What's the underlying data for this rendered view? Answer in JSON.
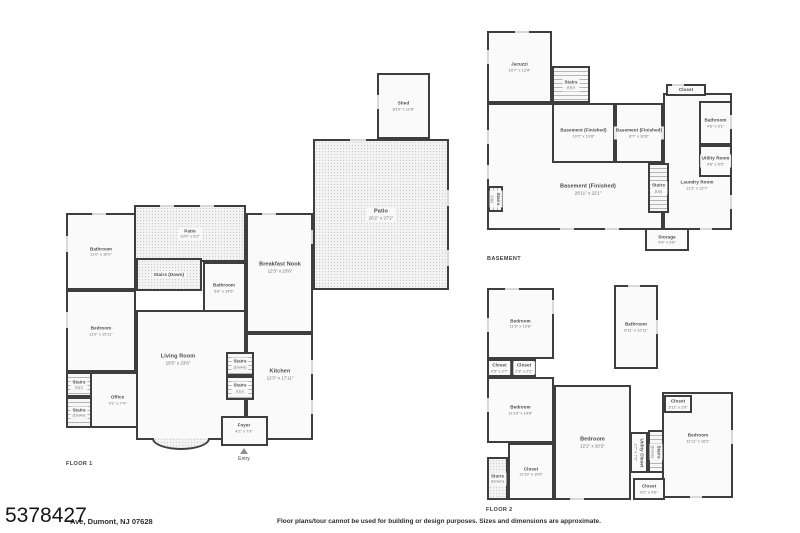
{
  "meta": {
    "mls_number": "5378427",
    "address": "Ave, Dumont, NJ 07628",
    "disclaimer": "Floor plans/tour cannot be used for building or design purposes. Sizes and dimensions are approximate."
  },
  "colors": {
    "wall": "#3e3e3e",
    "floor_fill": "#fafafa",
    "patio_fill": "#f3f3f3",
    "label_text": "#4a4a4a"
  },
  "plans": [
    {
      "id": "floor-1",
      "label": "FLOOR 1",
      "label_x": 66,
      "label_y": 461,
      "entry": {
        "label": "Entry",
        "x": 244,
        "y": 448
      },
      "bay": {
        "x": 152,
        "y": 438,
        "w": 58,
        "h": 12
      },
      "rooms": [
        {
          "name": "Patio",
          "dims": "26'2\" x 27'2\"",
          "x": 313,
          "y": 139,
          "w": 136,
          "h": 151,
          "type": "patio"
        },
        {
          "name": "Shed",
          "dims": "8'10\" x 11'8\"",
          "x": 377,
          "y": 73,
          "w": 53,
          "h": 66,
          "small": true
        },
        {
          "name": "Patio",
          "dims": "19'0\" x 6'2\"",
          "x": 134,
          "y": 205,
          "w": 112,
          "h": 57,
          "type": "patio",
          "small": true
        },
        {
          "name": "Bathroom",
          "dims": "11'0\" x 10'0\"",
          "x": 66,
          "y": 213,
          "w": 70,
          "h": 77,
          "small": true
        },
        {
          "name": "Bedroom",
          "dims": "11'9\" x 15'11\"",
          "x": 66,
          "y": 290,
          "w": 70,
          "h": 82,
          "small": true
        },
        {
          "name": "Office",
          "dims": "9'1\" x 7'4\"",
          "x": 90,
          "y": 372,
          "w": 55,
          "h": 56,
          "small": true
        },
        {
          "name": "Stairs",
          "dims": "(Up)",
          "x": 66,
          "y": 372,
          "w": 26,
          "h": 25,
          "type": "stairs-v",
          "small": true
        },
        {
          "name": "Stairs",
          "dims": "(Down)",
          "x": 66,
          "y": 397,
          "w": 26,
          "h": 31,
          "type": "stairs-v",
          "small": true
        },
        {
          "name": "Stairs (Down)",
          "x": 136,
          "y": 258,
          "w": 66,
          "h": 33,
          "type": "hatch",
          "small": true
        },
        {
          "name": "Living Room",
          "dims": "16'5\" x 23'6\"",
          "x": 136,
          "y": 310,
          "w": 110,
          "h": 130,
          "lx": 178,
          "ly": 360
        },
        {
          "name": "Breakfast Nook",
          "dims": "12'3\" x 23'6\"",
          "x": 246,
          "y": 213,
          "w": 67,
          "h": 120,
          "lx": 280,
          "ly": 268
        },
        {
          "name": "Kitchen",
          "dims": "12'3\" x 17'11\"",
          "x": 246,
          "y": 333,
          "w": 67,
          "h": 107,
          "lx": 280,
          "ly": 375
        },
        {
          "name": "Bathroom",
          "dims": "6'6\" x 14'5\"",
          "x": 203,
          "y": 262,
          "w": 43,
          "h": 50,
          "small": true,
          "lx": 224,
          "ly": 288
        },
        {
          "name": "Stairs",
          "dims": "(Down)",
          "x": 226,
          "y": 352,
          "w": 28,
          "h": 24,
          "type": "stairs-v",
          "small": true
        },
        {
          "name": "Stairs",
          "dims": "(Up)",
          "x": 226,
          "y": 376,
          "w": 28,
          "h": 24,
          "type": "stairs-v",
          "small": true
        },
        {
          "name": "Foyer",
          "dims": "4'2\" x 7'9\"",
          "x": 221,
          "y": 416,
          "w": 47,
          "h": 30,
          "small": true,
          "lx": 244,
          "ly": 428
        }
      ]
    },
    {
      "id": "basement",
      "label": "BASEMENT",
      "label_x": 487,
      "label_y": 256,
      "rooms": [
        {
          "name": "Basement (Finished)",
          "dims": "26'11\" x 22'1\"",
          "x": 487,
          "y": 103,
          "w": 176,
          "h": 127,
          "lx": 588,
          "ly": 190
        },
        {
          "name": "Jacuzzi",
          "dims": "10'7\" x 12'4\"",
          "x": 487,
          "y": 31,
          "w": 65,
          "h": 72,
          "small": true
        },
        {
          "name": "Stairs",
          "dims": "(Up)",
          "x": 552,
          "y": 66,
          "w": 38,
          "h": 37,
          "type": "stairs-v",
          "small": true
        },
        {
          "name": "Basement (Finished)",
          "dims": "10'2\" x 10'8\"",
          "x": 552,
          "y": 103,
          "w": 63,
          "h": 60,
          "small": true
        },
        {
          "name": "Basement (Finished)",
          "dims": "8'7\" x 10'8\"",
          "x": 615,
          "y": 103,
          "w": 48,
          "h": 60,
          "small": true
        },
        {
          "name": "Laundry Room",
          "dims": "11'3\" x 12'7\"",
          "x": 663,
          "y": 93,
          "w": 69,
          "h": 137,
          "lx": 697,
          "ly": 185,
          "small": true
        },
        {
          "name": "Closet",
          "x": 666,
          "y": 84,
          "w": 40,
          "h": 12,
          "small": true
        },
        {
          "name": "Bathroom",
          "dims": "4'6\" x 9'1\"",
          "x": 699,
          "y": 101,
          "w": 33,
          "h": 44,
          "small": true
        },
        {
          "name": "Utility Room",
          "dims": "4'6\" x 5'3\"",
          "x": 699,
          "y": 145,
          "w": 33,
          "h": 32,
          "small": true
        },
        {
          "name": "Stairs",
          "dims": "(Up)",
          "x": 648,
          "y": 163,
          "w": 21,
          "h": 50,
          "type": "stairs-v",
          "small": true
        },
        {
          "name": "Stairs",
          "dims": "(Up)",
          "x": 488,
          "y": 186,
          "w": 15,
          "h": 26,
          "type": "stairs-h",
          "small": true,
          "vert": true
        },
        {
          "name": "Storage",
          "dims": "9'9\" x 3'8\"",
          "x": 645,
          "y": 228,
          "w": 44,
          "h": 23,
          "small": true
        }
      ]
    },
    {
      "id": "floor-2",
      "label": "FLOOR 2",
      "label_x": 486,
      "label_y": 507,
      "rooms": [
        {
          "name": "Bedroom",
          "dims": "11'9\" x 12'8\"",
          "x": 487,
          "y": 288,
          "w": 67,
          "h": 71,
          "small": true
        },
        {
          "name": "Bathroom",
          "dims": "6'11\" x 12'11\"",
          "x": 614,
          "y": 285,
          "w": 44,
          "h": 84,
          "small": true
        },
        {
          "name": "Closet",
          "dims": "4'5\" x 2'7\"",
          "x": 487,
          "y": 359,
          "w": 25,
          "h": 18,
          "small": true
        },
        {
          "name": "Closet",
          "dims": "2'9\" x 2'2\"",
          "x": 512,
          "y": 359,
          "w": 24,
          "h": 18,
          "small": true
        },
        {
          "name": "Bedroom",
          "dims": "11'10\" x 14'8\"",
          "x": 487,
          "y": 377,
          "w": 67,
          "h": 66,
          "small": true
        },
        {
          "name": "Closet",
          "dims": "11'10\" x 10'6\"",
          "x": 508,
          "y": 443,
          "w": 46,
          "h": 57,
          "small": true
        },
        {
          "name": "Stairs",
          "dims": "(Down)",
          "x": 487,
          "y": 457,
          "w": 21,
          "h": 43,
          "type": "hatch",
          "small": true
        },
        {
          "name": "Bedroom",
          "dims": "12'2\" x 20'2\"",
          "x": 554,
          "y": 385,
          "w": 77,
          "h": 115
        },
        {
          "name": "Bedroom",
          "dims": "11'11\" x 16'2\"",
          "x": 662,
          "y": 392,
          "w": 71,
          "h": 106,
          "lx": 698,
          "ly": 438,
          "small": true
        },
        {
          "name": "Closet",
          "dims": "3'11\" x 2'9\"",
          "x": 664,
          "y": 395,
          "w": 28,
          "h": 18,
          "small": true
        },
        {
          "name": "Utility Closet",
          "dims": "2'7\" x 7'9\"",
          "x": 630,
          "y": 432,
          "w": 18,
          "h": 41,
          "small": true,
          "vert": true
        },
        {
          "name": "Stairs",
          "dims": "(Down)",
          "x": 648,
          "y": 430,
          "w": 16,
          "h": 43,
          "type": "stairs-v",
          "small": true,
          "vert": true
        },
        {
          "name": "Closet",
          "dims": "6'2\" x 4'6\"",
          "x": 633,
          "y": 478,
          "w": 32,
          "h": 22,
          "small": true
        }
      ]
    }
  ],
  "windows": [
    [
      66,
      236,
      2,
      16
    ],
    [
      66,
      312,
      2,
      16
    ],
    [
      92,
      213,
      14,
      2
    ],
    [
      262,
      213,
      14,
      2
    ],
    [
      160,
      205,
      14,
      2
    ],
    [
      200,
      205,
      14,
      2
    ],
    [
      377,
      95,
      2,
      14
    ],
    [
      350,
      139,
      16,
      2
    ],
    [
      447,
      190,
      2,
      16
    ],
    [
      447,
      250,
      2,
      16
    ],
    [
      311,
      230,
      2,
      14
    ],
    [
      311,
      360,
      2,
      14
    ],
    [
      311,
      400,
      2,
      14
    ],
    [
      487,
      50,
      2,
      14
    ],
    [
      515,
      31,
      14,
      2
    ],
    [
      487,
      130,
      2,
      14
    ],
    [
      487,
      165,
      2,
      14
    ],
    [
      560,
      228,
      14,
      2
    ],
    [
      605,
      228,
      14,
      2
    ],
    [
      730,
      115,
      2,
      14
    ],
    [
      730,
      195,
      2,
      14
    ],
    [
      672,
      84,
      12,
      2
    ],
    [
      700,
      228,
      12,
      2
    ],
    [
      505,
      288,
      14,
      2
    ],
    [
      487,
      318,
      2,
      14
    ],
    [
      487,
      398,
      2,
      14
    ],
    [
      628,
      285,
      12,
      2
    ],
    [
      656,
      320,
      2,
      14
    ],
    [
      570,
      498,
      14,
      2
    ],
    [
      690,
      496,
      12,
      2
    ],
    [
      731,
      430,
      2,
      14
    ],
    [
      552,
      300,
      2,
      14
    ]
  ]
}
